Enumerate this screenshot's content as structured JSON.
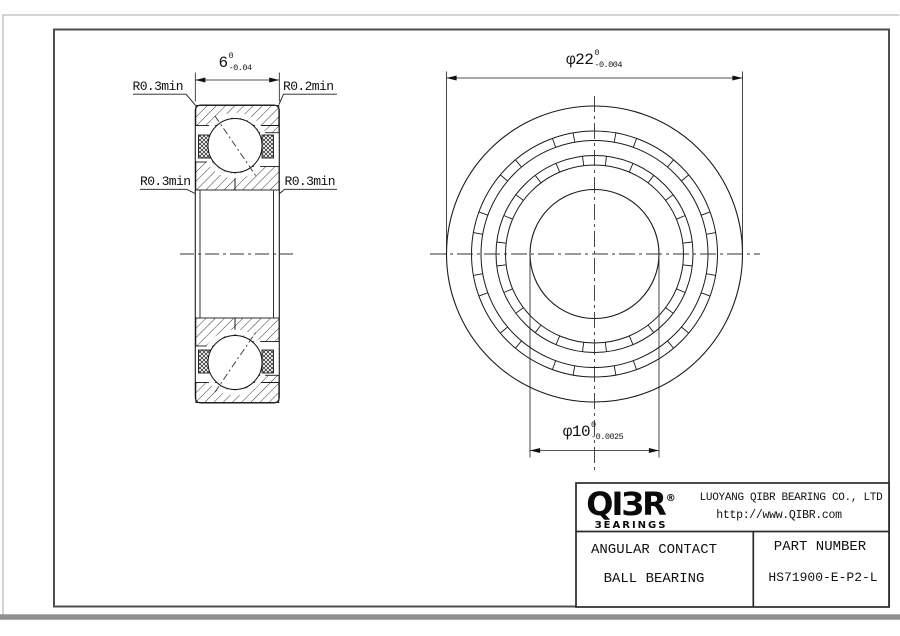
{
  "drawing": {
    "section_view": {
      "width_dim": {
        "value": "6",
        "tol_top": "0",
        "tol_bottom": "-0.04"
      },
      "corner_labels": {
        "top_left": "R0.3min",
        "top_right": "R0.2min",
        "mid_left": "R0.3min",
        "mid_right": "R0.3min"
      }
    },
    "front_view": {
      "outer_diameter_dim": {
        "value": "φ22",
        "tol_top": "0",
        "tol_bottom": "-0.004"
      },
      "bore_diameter_dim": {
        "value": "φ10",
        "tol_top": "0",
        "tol_bottom": "-0.0025"
      }
    }
  },
  "title_block": {
    "logo": {
      "name": "QIBR",
      "display": "QIЗR",
      "registered_mark": "®",
      "subtitle": "BEARINGS",
      "subtitle_display": "ЗEARINGS"
    },
    "company": "LUOYANG QIBR BEARING CO., LTD",
    "website": "http://www.QIBR.com",
    "product_type_line1": "ANGULAR CONTACT",
    "product_type_line2": "BALL BEARING",
    "part_number_label": "PART NUMBER",
    "part_number": "HS71900-E-P2-L"
  }
}
